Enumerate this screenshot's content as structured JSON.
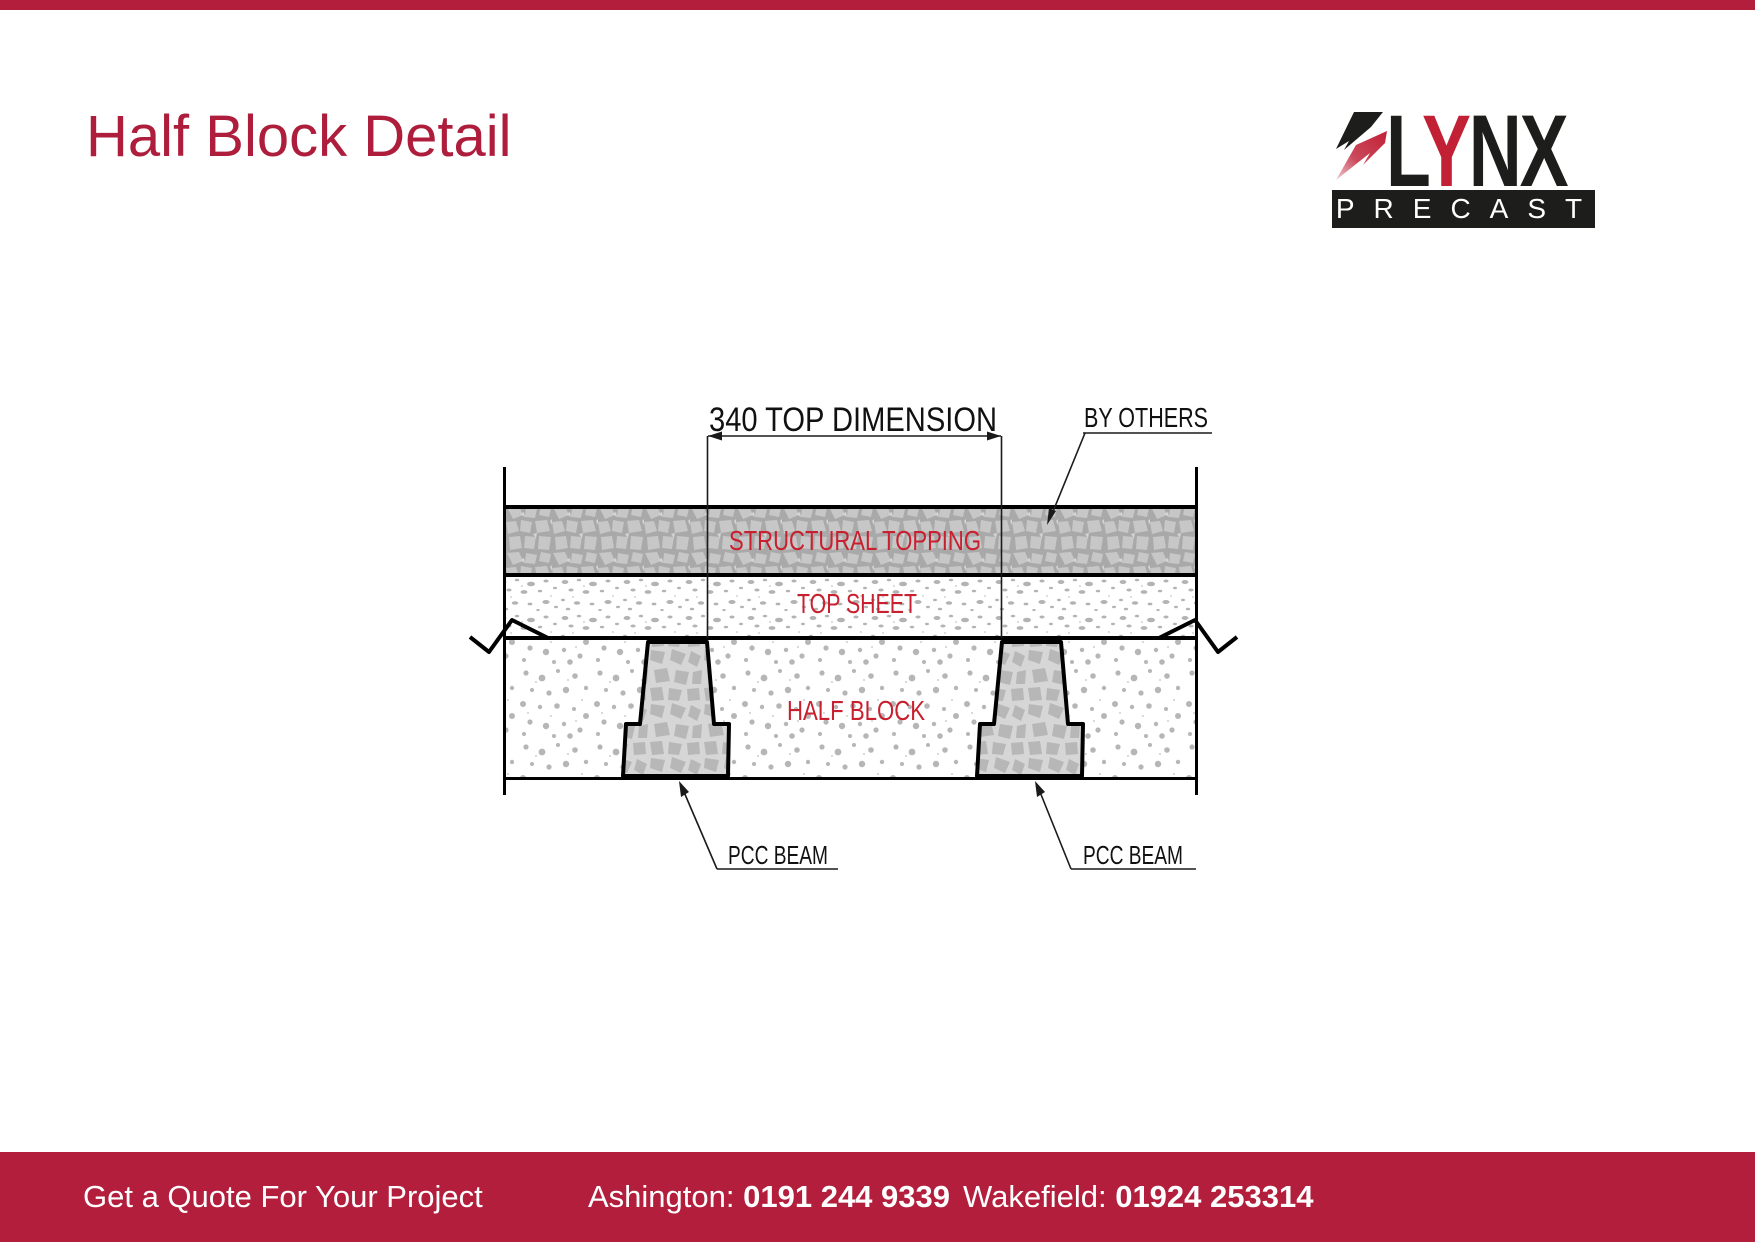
{
  "page": {
    "title": "Half Block Detail"
  },
  "logo": {
    "letter_l": "L",
    "letter_y": "Y",
    "letters_nx": "NX",
    "tagline": "PRECAST",
    "red": "#c22035",
    "black": "#1d1d1b"
  },
  "diagram": {
    "dimension_label": "340 TOP DIMENSION",
    "by_others_label": "BY OTHERS",
    "structural_topping_label": "STRUCTURAL TOPPING",
    "top_sheet_label": "TOP SHEET",
    "half_block_label": "HALF BLOCK",
    "pcc_beam_left_label": "PCC BEAM",
    "pcc_beam_right_label": "PCC BEAM",
    "label_red": "#c8202f"
  },
  "footer": {
    "cta": "Get a Quote For Your Project",
    "ashington_label": "Ashington:",
    "ashington_phone": "0191 244 9339",
    "wakefield_label": "Wakefield:",
    "wakefield_phone": "01924 253314",
    "bar_color": "#b31e3d"
  },
  "colors": {
    "brand_red": "#b31e3d",
    "title_red": "#ae1e3c"
  }
}
